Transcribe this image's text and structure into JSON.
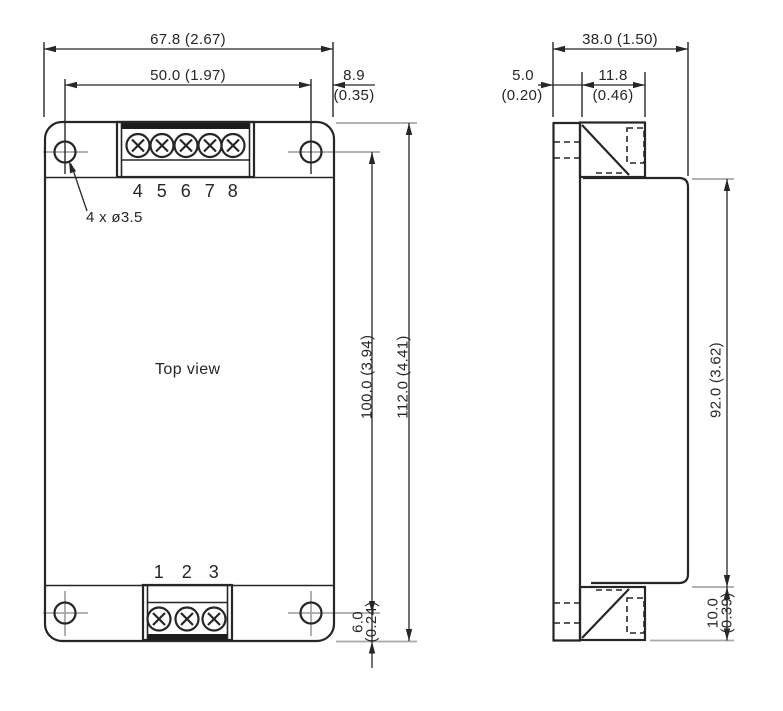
{
  "drawing": {
    "left_view": {
      "label": "Top view",
      "hole_callout": "4 x ø3.5",
      "top_pins": [
        "4",
        "5",
        "6",
        "7",
        "8"
      ],
      "bottom_pins": [
        "1",
        "2",
        "3"
      ],
      "dims": {
        "width_outer": "67.8 (2.67)",
        "width_holes": "50.0 (1.97)",
        "edge_offset_mm": "8.9",
        "edge_offset_in": "(0.35)",
        "height_holes": "100.0 (3.94)",
        "height_outer": "112.0 (4.41)",
        "bottom_offset_mm": "6.0",
        "bottom_offset_in": "(0.24)"
      }
    },
    "side_view": {
      "dims": {
        "depth_outer": "38.0 (1.50)",
        "plate_mm": "5.0",
        "plate_in": "(0.20)",
        "terminal_width_mm": "11.8",
        "terminal_width_in": "(0.46)",
        "body_height": "92.0 (3.62)",
        "terminal_height_mm": "10.0",
        "terminal_height_in": "(0.39)"
      }
    },
    "colors": {
      "line": "#262626",
      "aux": "#a8a8a8",
      "background": "#ffffff"
    }
  }
}
